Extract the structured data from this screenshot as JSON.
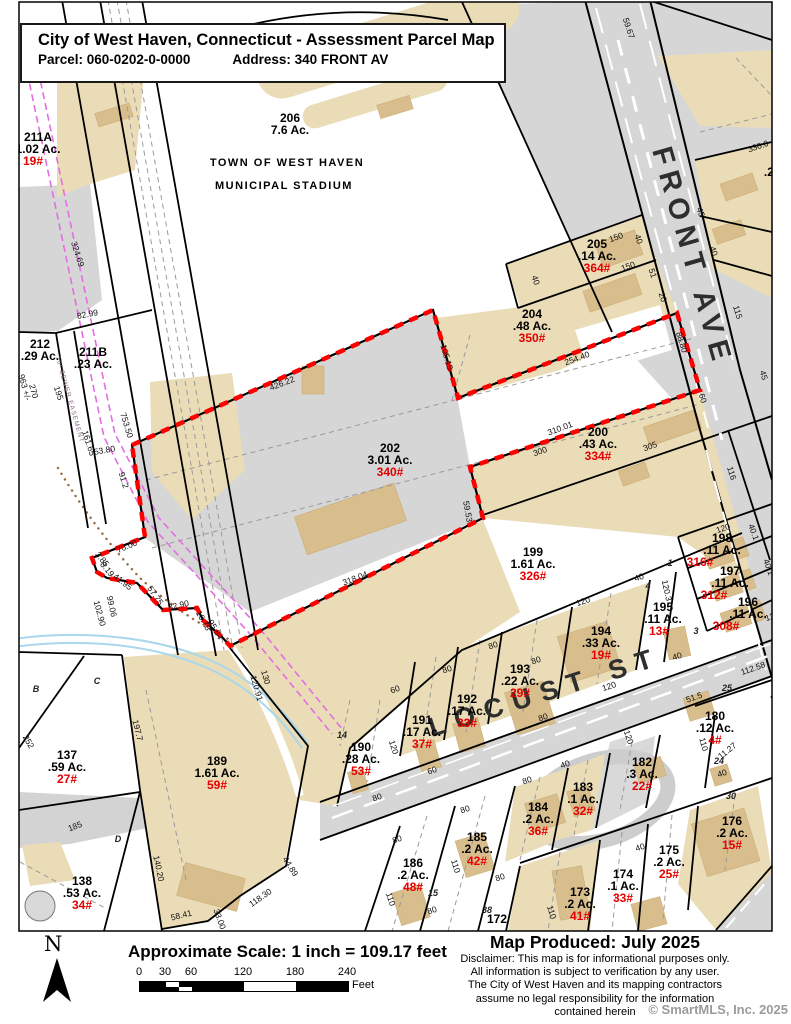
{
  "title_box": {
    "title": "City of West Haven, Connecticut - Assessment Parcel Map",
    "parcel_label": "Parcel: 060-0202-0-0000",
    "address_label": "Address: 340 FRONT AV"
  },
  "map": {
    "streets": [
      {
        "name": "FRONT AVE",
        "x": 652,
        "y": 150,
        "rot": 74,
        "size": 29,
        "ls": 7
      },
      {
        "name": "LOCUST ST",
        "x": 432,
        "y": 737,
        "rot": -17.5,
        "size": 27,
        "ls": 10
      }
    ],
    "stadium": {
      "lines": [
        {
          "t": "TOWN OF WEST HAVEN",
          "x": 287,
          "y": 166
        },
        {
          "t": "MUNICIPAL STADIUM",
          "x": 284,
          "y": 189
        }
      ]
    },
    "easement": {
      "t": "10' SEWER EASEMENT",
      "x": 68,
      "y": 400,
      "r": 74
    },
    "parcels": [
      {
        "id": "211A",
        "x": 38,
        "y": 141,
        "ac": "1.02 Ac.",
        "addr": "19#",
        "adx": -5
      },
      {
        "id": "206",
        "x": 290,
        "y": 122,
        "ac": "7.6 Ac.",
        "addr": ""
      },
      {
        "id": "212",
        "x": 40,
        "y": 348,
        "ac": ".29 Ac.",
        "addr": ""
      },
      {
        "id": "211B",
        "x": 93,
        "y": 356,
        "ac": ".23 Ac.",
        "addr": ""
      },
      {
        "id": "205",
        "x": 597,
        "y": 248,
        "ac": ".14 Ac.",
        "addr": "364#"
      },
      {
        "id": "204",
        "x": 532,
        "y": 318,
        "ac": ".48 Ac.",
        "addr": "350#"
      },
      {
        "id": "202",
        "x": 390,
        "y": 452,
        "ac": "3.01 Ac.",
        "addr": "340#"
      },
      {
        "id": "200",
        "x": 598,
        "y": 436,
        "ac": ".43 Ac.",
        "addr": "334#"
      },
      {
        "id": "199",
        "x": 533,
        "y": 556,
        "ac": "1.61 Ac.",
        "addr": "326#"
      },
      {
        "id": "198",
        "x": 722,
        "y": 542,
        "ac": ".11 Ac.",
        "addr": "316#",
        "adx": -22
      },
      {
        "id": "197",
        "x": 730,
        "y": 575,
        "ac": ".11 Ac.",
        "addr": "312#",
        "adx": -16
      },
      {
        "id": "196",
        "x": 748,
        "y": 606,
        "ac": ".11 Ac.",
        "addr": "308#",
        "adx": -22
      },
      {
        "id": "195",
        "x": 663,
        "y": 611,
        "ac": ".11 Ac.",
        "addr": "13#",
        "adx": -4
      },
      {
        "id": "194",
        "x": 601,
        "y": 635,
        "ac": ".33 Ac.",
        "addr": "19#"
      },
      {
        "id": "193",
        "x": 520,
        "y": 673,
        "ac": ".22 Ac.",
        "addr": "29#"
      },
      {
        "id": "192",
        "x": 467,
        "y": 703,
        "ac": ".17 Ac.",
        "addr": "33#"
      },
      {
        "id": "191",
        "x": 422,
        "y": 724,
        "ac": ".17 Ac.",
        "addr": "37#"
      },
      {
        "id": "190",
        "x": 361,
        "y": 751,
        "ac": ".28 Ac.",
        "addr": "53#"
      },
      {
        "id": "189",
        "x": 217,
        "y": 765,
        "ac": "1.61 Ac.",
        "addr": "59#"
      },
      {
        "id": "137",
        "x": 67,
        "y": 759,
        "ac": ".59 Ac.",
        "addr": "27#"
      },
      {
        "id": "138",
        "x": 82,
        "y": 885,
        "ac": ".53 Ac.",
        "addr": "34#"
      },
      {
        "id": "186",
        "x": 413,
        "y": 867,
        "ac": ".2 Ac.",
        "addr": "48#"
      },
      {
        "id": "185",
        "x": 477,
        "y": 841,
        "ac": ".2 Ac.",
        "addr": "42#"
      },
      {
        "id": "184",
        "x": 538,
        "y": 811,
        "ac": ".2 Ac.",
        "addr": "36#"
      },
      {
        "id": "183",
        "x": 583,
        "y": 791,
        "ac": ".1 Ac.",
        "addr": "32#"
      },
      {
        "id": "182",
        "x": 642,
        "y": 766,
        "ac": ".3 Ac.",
        "addr": "22#"
      },
      {
        "id": "180",
        "x": 715,
        "y": 720,
        "ac": ".12 Ac.",
        "addr": "4#"
      },
      {
        "id": "176",
        "x": 732,
        "y": 825,
        "ac": ".2 Ac.",
        "addr": "15#"
      },
      {
        "id": "175",
        "x": 669,
        "y": 854,
        "ac": ".2 Ac.",
        "addr": "25#"
      },
      {
        "id": "174",
        "x": 623,
        "y": 878,
        "ac": ".1 Ac.",
        "addr": "33#"
      },
      {
        "id": "173",
        "x": 580,
        "y": 896,
        "ac": ".2 Ac.",
        "addr": "41#"
      },
      {
        "id": "172",
        "x": 497,
        "y": 923,
        "ac": "",
        "addr": ""
      },
      {
        "id": "",
        "x": 783,
        "y": 164,
        "ac": ".23 Ac.",
        "addr": "35#"
      },
      {
        "id": "",
        "x": 787,
        "y": 208,
        "ac": ".1 Ac.",
        "addr": "3#"
      },
      {
        "id": "18",
        "x": 789,
        "y": 686,
        "ac": ".22 Ac.",
        "addr": "300#"
      }
    ],
    "dimensions": [
      {
        "t": "324.69",
        "x": 75,
        "y": 255,
        "r": 72
      },
      {
        "t": "82.99",
        "x": 88,
        "y": 317,
        "r": -11
      },
      {
        "t": "963 +/-",
        "x": 22,
        "y": 388,
        "r": 75
      },
      {
        "t": "270",
        "x": 31,
        "y": 392,
        "r": 75
      },
      {
        "t": "195",
        "x": 56,
        "y": 394,
        "r": 72
      },
      {
        "t": "161.65",
        "x": 86,
        "y": 444,
        "r": 72
      },
      {
        "t": "753.50",
        "x": 124,
        "y": 426,
        "r": 73
      },
      {
        "t": "53.80",
        "x": 105,
        "y": 453,
        "r": -10
      },
      {
        "t": "91.2",
        "x": 121,
        "y": 481,
        "r": 73
      },
      {
        "t": "426.22",
        "x": 283,
        "y": 386,
        "r": -21
      },
      {
        "t": "105.15",
        "x": 444,
        "y": 358,
        "r": 74
      },
      {
        "t": "254.40",
        "x": 578,
        "y": 361,
        "r": -20
      },
      {
        "t": "88.80",
        "x": 679,
        "y": 343,
        "r": 73
      },
      {
        "t": "310.01",
        "x": 561,
        "y": 431,
        "r": -20
      },
      {
        "t": "300",
        "x": 541,
        "y": 454,
        "r": -20
      },
      {
        "t": "305",
        "x": 651,
        "y": 449,
        "r": -20
      },
      {
        "t": "59.53",
        "x": 465,
        "y": 512,
        "r": 80
      },
      {
        "t": "318.04",
        "x": 356,
        "y": 581,
        "r": -21
      },
      {
        "t": "70.00",
        "x": 128,
        "y": 549,
        "r": -23
      },
      {
        "t": "3.85",
        "x": 100,
        "y": 561,
        "r": 50
      },
      {
        "t": "8.19",
        "x": 105,
        "y": 571,
        "r": 50
      },
      {
        "t": "41.95",
        "x": 121,
        "y": 584,
        "r": 38
      },
      {
        "t": "57.75",
        "x": 153,
        "y": 597,
        "r": 55
      },
      {
        "t": "32.90",
        "x": 179,
        "y": 608,
        "r": -12
      },
      {
        "t": "10.78",
        "x": 201,
        "y": 622,
        "r": 60
      },
      {
        "t": "95.84",
        "x": 213,
        "y": 631,
        "r": 60
      },
      {
        "t": "102.90",
        "x": 97,
        "y": 614,
        "r": 75
      },
      {
        "t": "99.06",
        "x": 109,
        "y": 607,
        "r": 78
      },
      {
        "t": "150",
        "x": 617,
        "y": 240,
        "r": -20
      },
      {
        "t": "40",
        "x": 636,
        "y": 240,
        "r": 72
      },
      {
        "t": "150",
        "x": 629,
        "y": 269,
        "r": -20
      },
      {
        "t": "51",
        "x": 650,
        "y": 274,
        "r": 72
      },
      {
        "t": "20",
        "x": 660,
        "y": 298,
        "r": 72
      },
      {
        "t": "40",
        "x": 533,
        "y": 281,
        "r": 72
      },
      {
        "t": "59.67",
        "x": 626,
        "y": 29,
        "r": 72
      },
      {
        "t": "336.0",
        "x": 759,
        "y": 149,
        "r": -19
      },
      {
        "t": "45",
        "x": 698,
        "y": 213,
        "r": 72
      },
      {
        "t": "40",
        "x": 711,
        "y": 252,
        "r": 72
      },
      {
        "t": "115",
        "x": 735,
        "y": 313,
        "r": 73
      },
      {
        "t": "45",
        "x": 761,
        "y": 376,
        "r": 73
      },
      {
        "t": "60",
        "x": 700,
        "y": 399,
        "r": 73
      },
      {
        "t": "116",
        "x": 729,
        "y": 474,
        "r": 73
      },
      {
        "t": "120.91",
        "x": 254,
        "y": 689,
        "r": 74
      },
      {
        "t": "130",
        "x": 263,
        "y": 678,
        "r": 74
      },
      {
        "t": "197.7",
        "x": 135,
        "y": 731,
        "r": 76
      },
      {
        "t": "252",
        "x": 26,
        "y": 743,
        "r": 60
      },
      {
        "t": "185",
        "x": 76,
        "y": 829,
        "r": -21
      },
      {
        "t": "140.20",
        "x": 156,
        "y": 869,
        "r": 78
      },
      {
        "t": "58.41",
        "x": 182,
        "y": 918,
        "r": -14
      },
      {
        "t": "33.00",
        "x": 217,
        "y": 920,
        "r": 70
      },
      {
        "t": "118.30",
        "x": 262,
        "y": 900,
        "r": -35
      },
      {
        "t": "44.89",
        "x": 288,
        "y": 868,
        "r": 58
      },
      {
        "t": "112.58",
        "x": 754,
        "y": 671,
        "r": -19
      },
      {
        "t": "51.5",
        "x": 695,
        "y": 700,
        "r": -19
      },
      {
        "t": "110",
        "x": 701,
        "y": 745,
        "r": 75
      },
      {
        "t": "11.27",
        "x": 729,
        "y": 753,
        "r": -38
      },
      {
        "t": "40",
        "x": 723,
        "y": 776,
        "r": -19
      },
      {
        "t": "120",
        "x": 610,
        "y": 689,
        "r": -19
      },
      {
        "t": "120",
        "x": 626,
        "y": 738,
        "r": 72
      },
      {
        "t": "80",
        "x": 494,
        "y": 648,
        "r": -19
      },
      {
        "t": "80",
        "x": 448,
        "y": 672,
        "r": -19
      },
      {
        "t": "60",
        "x": 396,
        "y": 692,
        "r": -19
      },
      {
        "t": "80",
        "x": 544,
        "y": 720,
        "r": -19
      },
      {
        "t": "120",
        "x": 391,
        "y": 748,
        "r": 73
      },
      {
        "t": "60",
        "x": 433,
        "y": 773,
        "r": -19
      },
      {
        "t": "80",
        "x": 528,
        "y": 783,
        "r": -19
      },
      {
        "t": "80",
        "x": 378,
        "y": 800,
        "r": -19
      },
      {
        "t": "80",
        "x": 466,
        "y": 812,
        "r": -19
      },
      {
        "t": "40",
        "x": 566,
        "y": 767,
        "r": -19
      },
      {
        "t": "40",
        "x": 641,
        "y": 850,
        "r": -19
      },
      {
        "t": "80",
        "x": 398,
        "y": 842,
        "r": -19
      },
      {
        "t": "110",
        "x": 453,
        "y": 867,
        "r": 73
      },
      {
        "t": "80",
        "x": 501,
        "y": 880,
        "r": -19
      },
      {
        "t": "110",
        "x": 388,
        "y": 900,
        "r": 73
      },
      {
        "t": "80",
        "x": 433,
        "y": 913,
        "r": -19
      },
      {
        "t": "110",
        "x": 549,
        "y": 913,
        "r": 73
      },
      {
        "t": "120",
        "x": 584,
        "y": 604,
        "r": -19
      },
      {
        "t": "40",
        "x": 640,
        "y": 580,
        "r": -19
      },
      {
        "t": "120.3",
        "x": 664,
        "y": 591,
        "r": 78
      },
      {
        "t": "40",
        "x": 678,
        "y": 659,
        "r": -19
      },
      {
        "t": "120",
        "x": 724,
        "y": 531,
        "r": -19
      },
      {
        "t": "40.1",
        "x": 751,
        "y": 533,
        "r": 70
      },
      {
        "t": "40.1",
        "x": 766,
        "y": 568,
        "r": 70
      },
      {
        "t": "120",
        "x": 773,
        "y": 619,
        "r": -19
      },
      {
        "t": "80",
        "x": 537,
        "y": 663,
        "r": -19
      }
    ],
    "lot_numbers": [
      {
        "t": "B",
        "x": 36,
        "y": 692
      },
      {
        "t": "C",
        "x": 97,
        "y": 684
      },
      {
        "t": "D",
        "x": 118,
        "y": 842
      },
      {
        "t": "1",
        "x": 670,
        "y": 566
      },
      {
        "t": "4",
        "x": 648,
        "y": 589
      },
      {
        "t": "3",
        "x": 696,
        "y": 634
      },
      {
        "t": "25",
        "x": 727,
        "y": 691
      },
      {
        "t": "24",
        "x": 719,
        "y": 764
      },
      {
        "t": "30",
        "x": 731,
        "y": 799
      },
      {
        "t": "14",
        "x": 342,
        "y": 738
      },
      {
        "t": "15",
        "x": 433,
        "y": 896
      },
      {
        "t": "38",
        "x": 487,
        "y": 913
      }
    ]
  },
  "footer": {
    "north": "N",
    "scale_label": "Approximate Scale:  1 inch = 109.17 feet",
    "scale_ticks": [
      "0",
      "30",
      "60",
      "120",
      "180",
      "240"
    ],
    "unit": "Feet",
    "produced": "Map Produced: July 2025",
    "disclaimer": [
      "Disclaimer: This map is for informational purposes only.",
      "All information is subject to verification by any user.",
      "The City of West Haven and its mapping contractors",
      "assume no legal responsibility for the information",
      "contained herein"
    ],
    "copyright": "© SmartMLS, Inc.  2025"
  },
  "colors": {
    "subject_boundary": "#ff0000",
    "address_text": "#e60000",
    "parcel_tan": "#e9dcb6",
    "building_tan": "#d8bd8d",
    "road_gray": "#d6d6d6",
    "easement_magenta": "#e36ee3",
    "stream_blue": "#a9d7ec"
  }
}
